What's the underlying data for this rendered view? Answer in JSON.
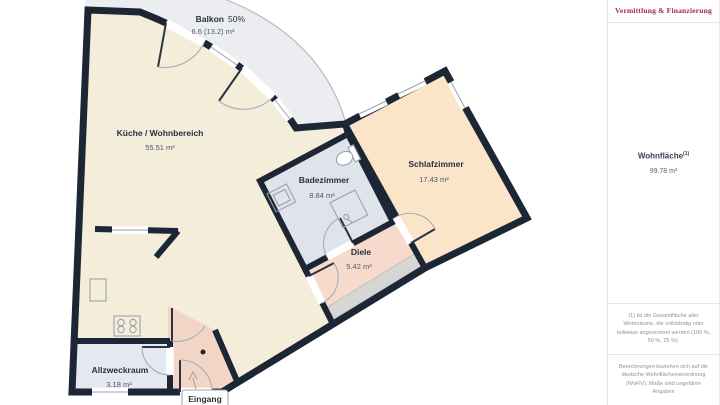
{
  "plan": {
    "rooms": [
      {
        "name": "Balkon",
        "suffix": "50%",
        "area": "6.6 (13.2) m²"
      },
      {
        "name": "Küche / Wohnbereich",
        "area": "55.51 m²"
      },
      {
        "name": "Badezimmer",
        "area": "8.84 m²"
      },
      {
        "name": "Schlafzimmer",
        "area": "17.43 m²"
      },
      {
        "name": "Diele",
        "area": "5.42 m²"
      },
      {
        "name": "Allzweckraum",
        "area": "3.18 m²"
      }
    ],
    "entrance_label": "Eingang",
    "colors": {
      "wall": "#1d2634",
      "balcony": "#ecedf0",
      "kitchen": "#f3edda",
      "bedroom": "#fbe5c9",
      "bathroom": "#dee3ec",
      "hallway": "#f6dbcc",
      "entry": "#f3d5c5",
      "utility": "#e4e8ef",
      "wardrobe": "#d6d7d4"
    }
  },
  "sidebar": {
    "logo_tagline": "Vermittlung & Finanzierung",
    "living_area_label": "Wohnfläche",
    "living_area_sup": "(1)",
    "living_area_value": "99.78 m²",
    "footnote": "(1) Ist die Gesamtfläche aller Wohnräume, die vollständig oder teilweise angerechnet werden (100 %, 50 %, 25 %).",
    "disclaimer": "Berechnungen beziehen sich auf die deutsche Wohnflächenverordnung (WoFlV). Maße sind ungefähre Angaben"
  }
}
